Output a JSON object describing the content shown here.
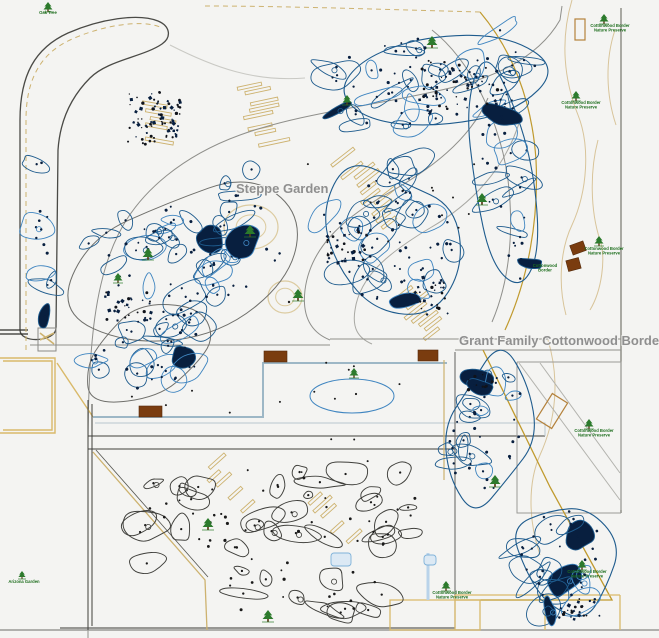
{
  "canvas": {
    "width": 659,
    "height": 638,
    "background": "#f4f4f2"
  },
  "labels": {
    "steppe": {
      "text": "Steppe Garden",
      "x": 236,
      "y": 193
    },
    "cottonwood": {
      "text": "Grant Family Cottonwood Border",
      "x": 459,
      "y": 345
    }
  },
  "colors": {
    "bed_blue": "#1e5b8d",
    "bed_blue_light": "#3f85c0",
    "plant_dot": "#081f3f",
    "bed_black": "#3f3f3b",
    "road_dark": "#4a4a46",
    "road_gray": "#8f8f8b",
    "tan": "#cdb26f",
    "tan_light": "#dccba0",
    "olive": "#c09a2e",
    "steel": "#9db7c6",
    "lightblue": "#7fb2d9",
    "bench_brown": "#7a3c0f",
    "tree_green": "#2c7a2c",
    "label_gray": "#8f8f8f",
    "mini_green": "#1e6e1e"
  },
  "mini_labels": [
    {
      "x": 48,
      "y": 14,
      "lines": [
        "Oak Tree"
      ]
    },
    {
      "x": 610,
      "y": 27,
      "lines": [
        "Cottonwood Border",
        "Nature Preserve"
      ]
    },
    {
      "x": 581,
      "y": 104,
      "lines": [
        "Cottonwood Border",
        "Nature Preserve"
      ]
    },
    {
      "x": 604,
      "y": 250,
      "lines": [
        "Cottonwood Border",
        "Nature Preserve"
      ]
    },
    {
      "x": 545,
      "y": 267,
      "lines": [
        "Cottonwood",
        "Border"
      ]
    },
    {
      "x": 594,
      "y": 432,
      "lines": [
        "Cottonwood Border",
        "Nature Preserve"
      ]
    },
    {
      "x": 587,
      "y": 573,
      "lines": [
        "Cottonwood Border",
        "Nature Preserve"
      ]
    },
    {
      "x": 452,
      "y": 594,
      "lines": [
        "Cottonwood Border",
        "Nature Preserve"
      ]
    },
    {
      "x": 24,
      "y": 583,
      "lines": [
        "Arizona Garden"
      ]
    }
  ],
  "trees": [
    {
      "x": 48,
      "y": 7,
      "s": 5
    },
    {
      "x": 148,
      "y": 254,
      "s": 6
    },
    {
      "x": 250,
      "y": 231,
      "s": 6
    },
    {
      "x": 298,
      "y": 295,
      "s": 6
    },
    {
      "x": 347,
      "y": 100,
      "s": 5
    },
    {
      "x": 432,
      "y": 42,
      "s": 6
    },
    {
      "x": 482,
      "y": 199,
      "s": 6
    },
    {
      "x": 118,
      "y": 278,
      "s": 5
    },
    {
      "x": 208,
      "y": 524,
      "s": 6
    },
    {
      "x": 268,
      "y": 616,
      "s": 6
    },
    {
      "x": 446,
      "y": 586,
      "s": 5
    },
    {
      "x": 495,
      "y": 481,
      "s": 6
    },
    {
      "x": 604,
      "y": 19,
      "s": 5
    },
    {
      "x": 576,
      "y": 96,
      "s": 5
    },
    {
      "x": 599,
      "y": 241,
      "s": 5
    },
    {
      "x": 589,
      "y": 424,
      "s": 5
    },
    {
      "x": 582,
      "y": 565,
      "s": 5
    },
    {
      "x": 22,
      "y": 575,
      "s": 4
    },
    {
      "x": 354,
      "y": 373,
      "s": 5
    }
  ],
  "benches": [
    {
      "x": 264,
      "y": 351,
      "w": 23,
      "h": 11,
      "rot": 0
    },
    {
      "x": 418,
      "y": 350,
      "w": 20,
      "h": 11,
      "rot": 0
    },
    {
      "x": 139,
      "y": 406,
      "w": 23,
      "h": 11,
      "rot": 0
    },
    {
      "x": 571,
      "y": 243,
      "w": 14,
      "h": 10,
      "rot": -20
    },
    {
      "x": 567,
      "y": 259,
      "w": 13,
      "h": 11,
      "rot": -15
    }
  ],
  "tan_outline_rects": [
    {
      "x": 575,
      "y": 19,
      "w": 10,
      "h": 21,
      "rot": 0
    },
    {
      "x": 543,
      "y": 396,
      "w": 18,
      "h": 30,
      "rot": 32
    }
  ],
  "lawn_ovals": [
    {
      "cx": 251,
      "cy": 227,
      "rx": 27,
      "ry": 22
    },
    {
      "cx": 285,
      "cy": 297,
      "rx": 17,
      "ry": 16
    }
  ],
  "pond": {
    "cx": 352,
    "cy": 396,
    "rx": 42,
    "ry": 17
  },
  "outlines": [
    {
      "cx": 190,
      "cy": 258,
      "rx": 120,
      "ry": 78,
      "rot": -22,
      "color": "#6f6f6b",
      "w": 1,
      "seed": 11
    },
    {
      "cx": 148,
      "cy": 352,
      "rx": 78,
      "ry": 45,
      "rot": -12,
      "color": "#6f6f6b",
      "w": 1,
      "seed": 12
    },
    {
      "cx": 430,
      "cy": 82,
      "rx": 126,
      "ry": 60,
      "rot": -6,
      "color": "#1e5b8d",
      "w": 1.1,
      "seed": 13
    },
    {
      "cx": 392,
      "cy": 240,
      "rx": 74,
      "ry": 86,
      "rot": -28,
      "color": "#1e5b8d",
      "w": 1.1,
      "seed": 14
    },
    {
      "cx": 505,
      "cy": 185,
      "rx": 36,
      "ry": 112,
      "rot": -8,
      "color": "#1e5b8d",
      "w": 1.1,
      "seed": 15
    },
    {
      "cx": 487,
      "cy": 432,
      "rx": 48,
      "ry": 76,
      "rot": 8,
      "color": "#1e5b8d",
      "w": 1.1,
      "seed": 16
    },
    {
      "cx": 566,
      "cy": 562,
      "rx": 53,
      "ry": 62,
      "rot": -18,
      "color": "#1e5b8d",
      "w": 1.1,
      "seed": 17
    }
  ],
  "clusters": [
    {
      "name": "steppe-upper",
      "cx": 190,
      "cy": 255,
      "rx": 112,
      "ry": 70,
      "rot": -22,
      "blobs": 34,
      "dots": 50,
      "style": "blue",
      "seed": 21
    },
    {
      "name": "steppe-lower",
      "cx": 150,
      "cy": 350,
      "rx": 72,
      "ry": 42,
      "rot": -14,
      "blobs": 16,
      "dots": 24,
      "style": "blue",
      "seed": 22
    },
    {
      "name": "left-strip",
      "cx": 44,
      "cy": 235,
      "rx": 11,
      "ry": 100,
      "rot": 0,
      "blobs": 6,
      "dots": 10,
      "style": "blue",
      "seed": 23
    },
    {
      "name": "top-center",
      "cx": 430,
      "cy": 80,
      "rx": 118,
      "ry": 54,
      "rot": -7,
      "blobs": 30,
      "dots": 44,
      "style": "blue",
      "seed": 24
    },
    {
      "name": "mid-center",
      "cx": 390,
      "cy": 238,
      "rx": 68,
      "ry": 80,
      "rot": -30,
      "blobs": 26,
      "dots": 38,
      "style": "blue",
      "seed": 25
    },
    {
      "name": "right-band",
      "cx": 508,
      "cy": 190,
      "rx": 28,
      "ry": 104,
      "rot": -6,
      "blobs": 12,
      "dots": 20,
      "style": "blue",
      "seed": 26
    },
    {
      "name": "triangle-upper",
      "cx": 485,
      "cy": 430,
      "rx": 44,
      "ry": 70,
      "rot": 10,
      "blobs": 16,
      "dots": 24,
      "style": "blue",
      "seed": 27
    },
    {
      "name": "triangle-lower",
      "cx": 565,
      "cy": 560,
      "rx": 48,
      "ry": 58,
      "rot": -20,
      "blobs": 18,
      "dots": 26,
      "style": "blue",
      "seed": 28
    },
    {
      "name": "bottom-middle",
      "cx": 270,
      "cy": 518,
      "rx": 172,
      "ry": 56,
      "rot": -3,
      "blobs": 30,
      "dots": 40,
      "style": "black",
      "seed": 29
    },
    {
      "name": "bottom-strip",
      "cx": 300,
      "cy": 593,
      "rx": 115,
      "ry": 28,
      "rot": 0,
      "blobs": 10,
      "dots": 14,
      "style": "black",
      "seed": 30
    }
  ],
  "dense_spots": [
    {
      "x": 128,
      "y": 92,
      "w": 54,
      "h": 54,
      "n": 80,
      "seed": 41
    },
    {
      "x": 420,
      "y": 60,
      "w": 78,
      "h": 52,
      "n": 60,
      "seed": 42
    },
    {
      "x": 325,
      "y": 225,
      "w": 42,
      "h": 38,
      "n": 38,
      "seed": 43
    },
    {
      "x": 415,
      "y": 275,
      "w": 34,
      "h": 38,
      "n": 28,
      "seed": 44
    },
    {
      "x": 105,
      "y": 292,
      "w": 52,
      "h": 30,
      "n": 24,
      "seed": 45
    },
    {
      "x": 556,
      "y": 596,
      "w": 44,
      "h": 22,
      "n": 22,
      "seed": 46
    },
    {
      "x": 468,
      "y": 372,
      "w": 26,
      "h": 22,
      "n": 14,
      "seed": 47
    }
  ],
  "ladders": [
    {
      "x": 150,
      "y": 88,
      "rot": 10,
      "rows": 9,
      "rlen": 34,
      "gap": 7,
      "seed": 51
    },
    {
      "x": 243,
      "y": 86,
      "rot": -12,
      "rows": 11,
      "rlen": 30,
      "gap": 6,
      "seed": 52
    },
    {
      "x": 330,
      "y": 155,
      "rot": -38,
      "rows": 12,
      "rlen": 26,
      "gap": 8,
      "seed": 53
    },
    {
      "x": 395,
      "y": 298,
      "rot": -38,
      "rows": 8,
      "rlen": 24,
      "gap": 7,
      "seed": 54
    },
    {
      "x": 205,
      "y": 470,
      "rot": -42,
      "rows": 10,
      "rlen": 22,
      "gap": 9,
      "seed": 55
    },
    {
      "x": 300,
      "y": 498,
      "rot": -42,
      "rows": 8,
      "rlen": 22,
      "gap": 9,
      "seed": 56
    }
  ],
  "scatter_dots": [
    {
      "x": 300,
      "y": 140,
      "w": 180,
      "h": 120,
      "n": 12,
      "seed": 61
    },
    {
      "x": 120,
      "y": 380,
      "w": 260,
      "h": 60,
      "n": 8,
      "seed": 62
    },
    {
      "x": 320,
      "y": 360,
      "w": 120,
      "h": 120,
      "n": 6,
      "seed": 63
    }
  ],
  "lightblue_patches": [
    {
      "x": 331,
      "y": 553,
      "w": 20,
      "h": 13
    },
    {
      "x": 424,
      "y": 555,
      "w": 12,
      "h": 10
    }
  ]
}
